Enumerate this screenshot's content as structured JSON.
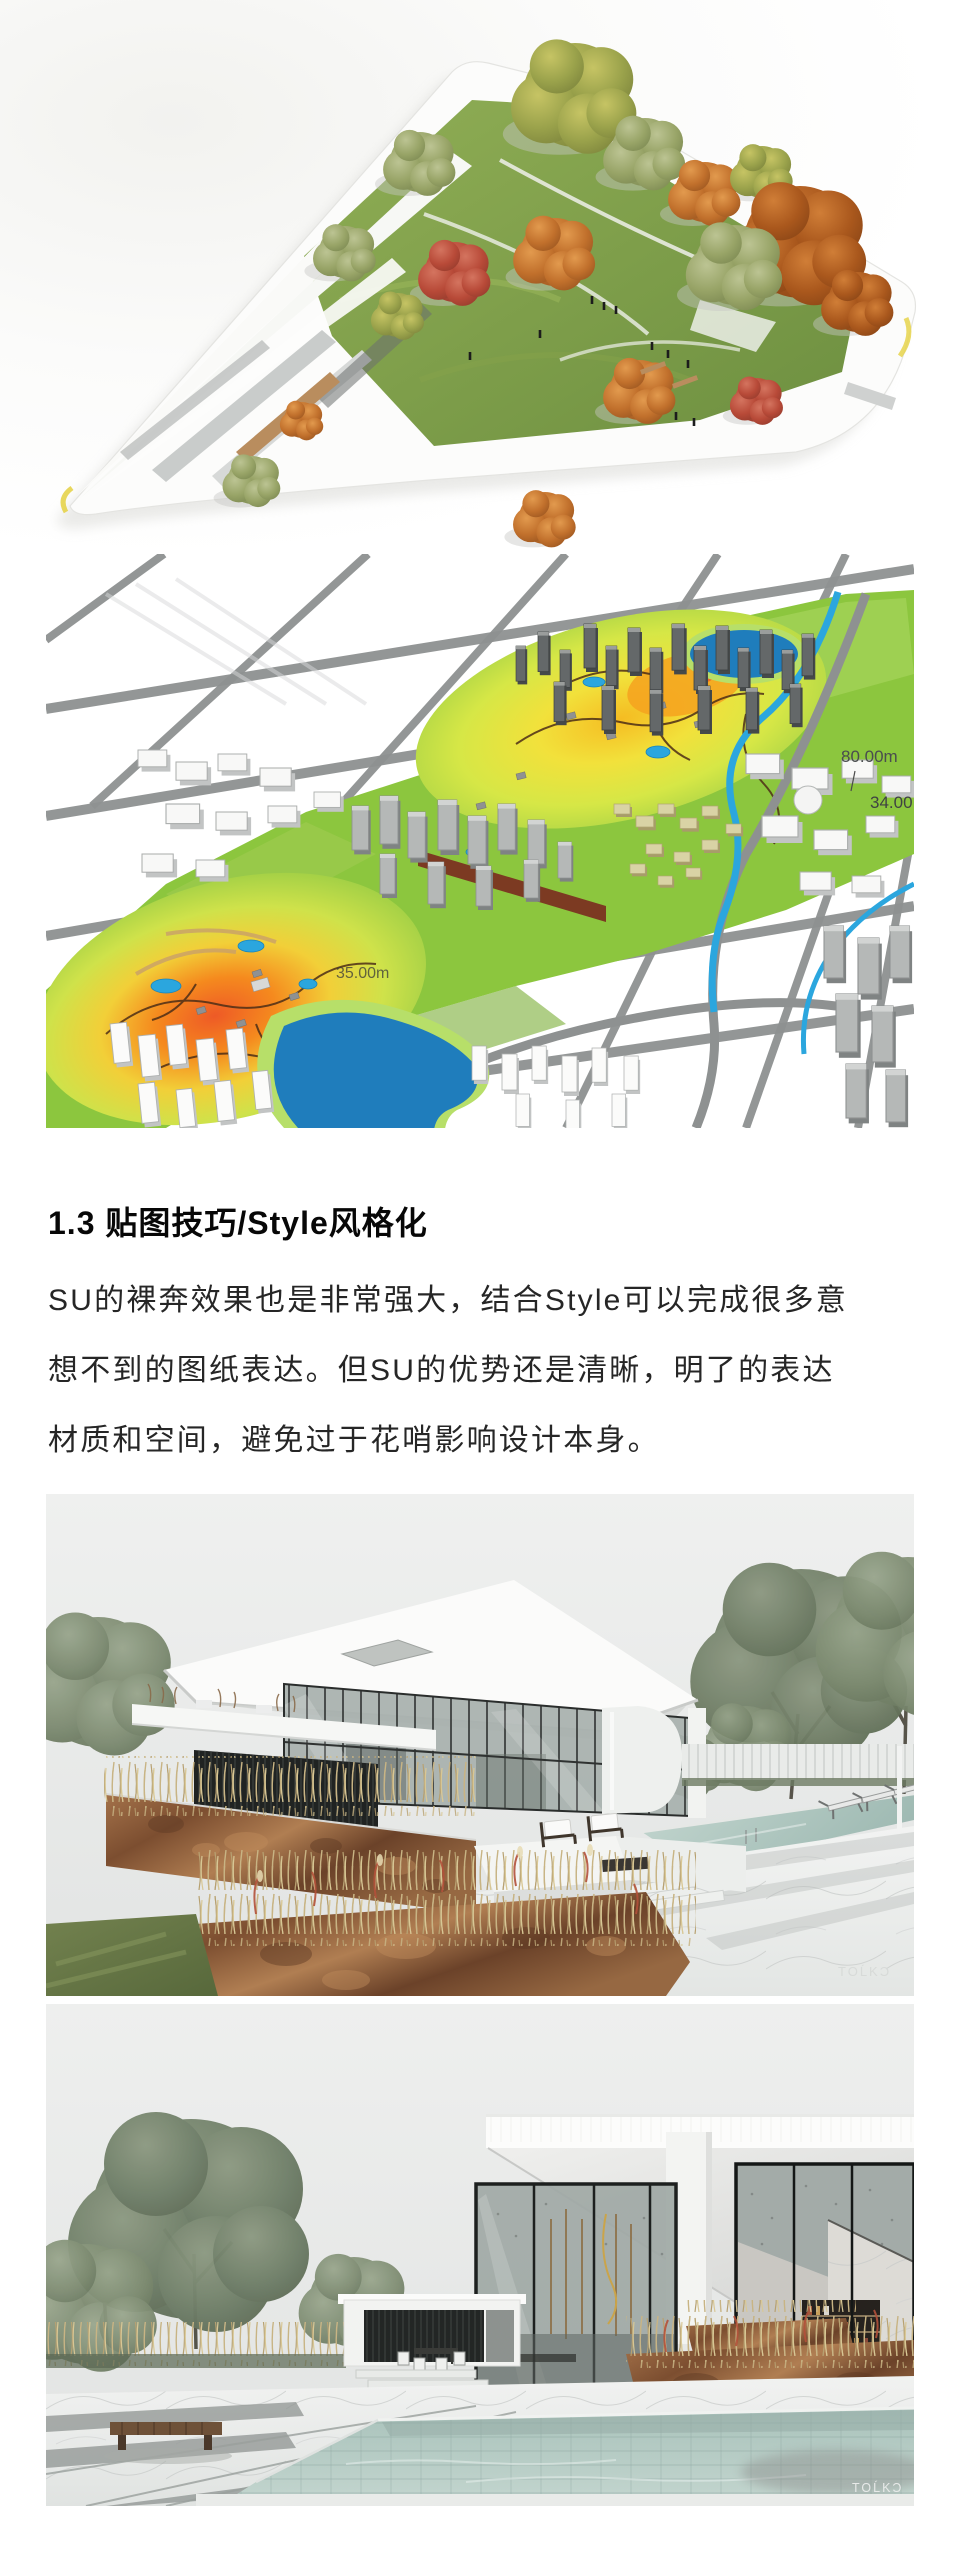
{
  "article": {
    "heading": "1.3 贴图技巧/Style风格化",
    "paragraph_lines": [
      "SU的裸奔效果也是非常强大，结合Style可以完成很多意",
      "想不到的图纸表达。但SU的优势还是清晰，明了的表达",
      "材质和空间，避免过于花哨影响设计本身。"
    ]
  },
  "figures": {
    "city_heatmap": {
      "labels": [
        "80.00m",
        "34.00",
        "35.00m"
      ]
    },
    "villa_terrace": {
      "watermark": "TOĹKƆ"
    },
    "villa_pool": {
      "watermark": "TOĹKƆ"
    }
  },
  "colors": {
    "park_green": "#8cc63e",
    "heat_yellow": "#f2e13b",
    "heat_orange": "#f58a1e",
    "heat_red": "#ee5a26",
    "water_blue": "#1f7dbc",
    "river_blue": "#2ba6de",
    "road_gray": "#8e9191",
    "sky_gray": "#e9ebea",
    "pool_teal": "#b3cac3",
    "corten_rust": "#8a5a3a",
    "dry_grass": "#c8b484",
    "text_black": "#262626"
  }
}
